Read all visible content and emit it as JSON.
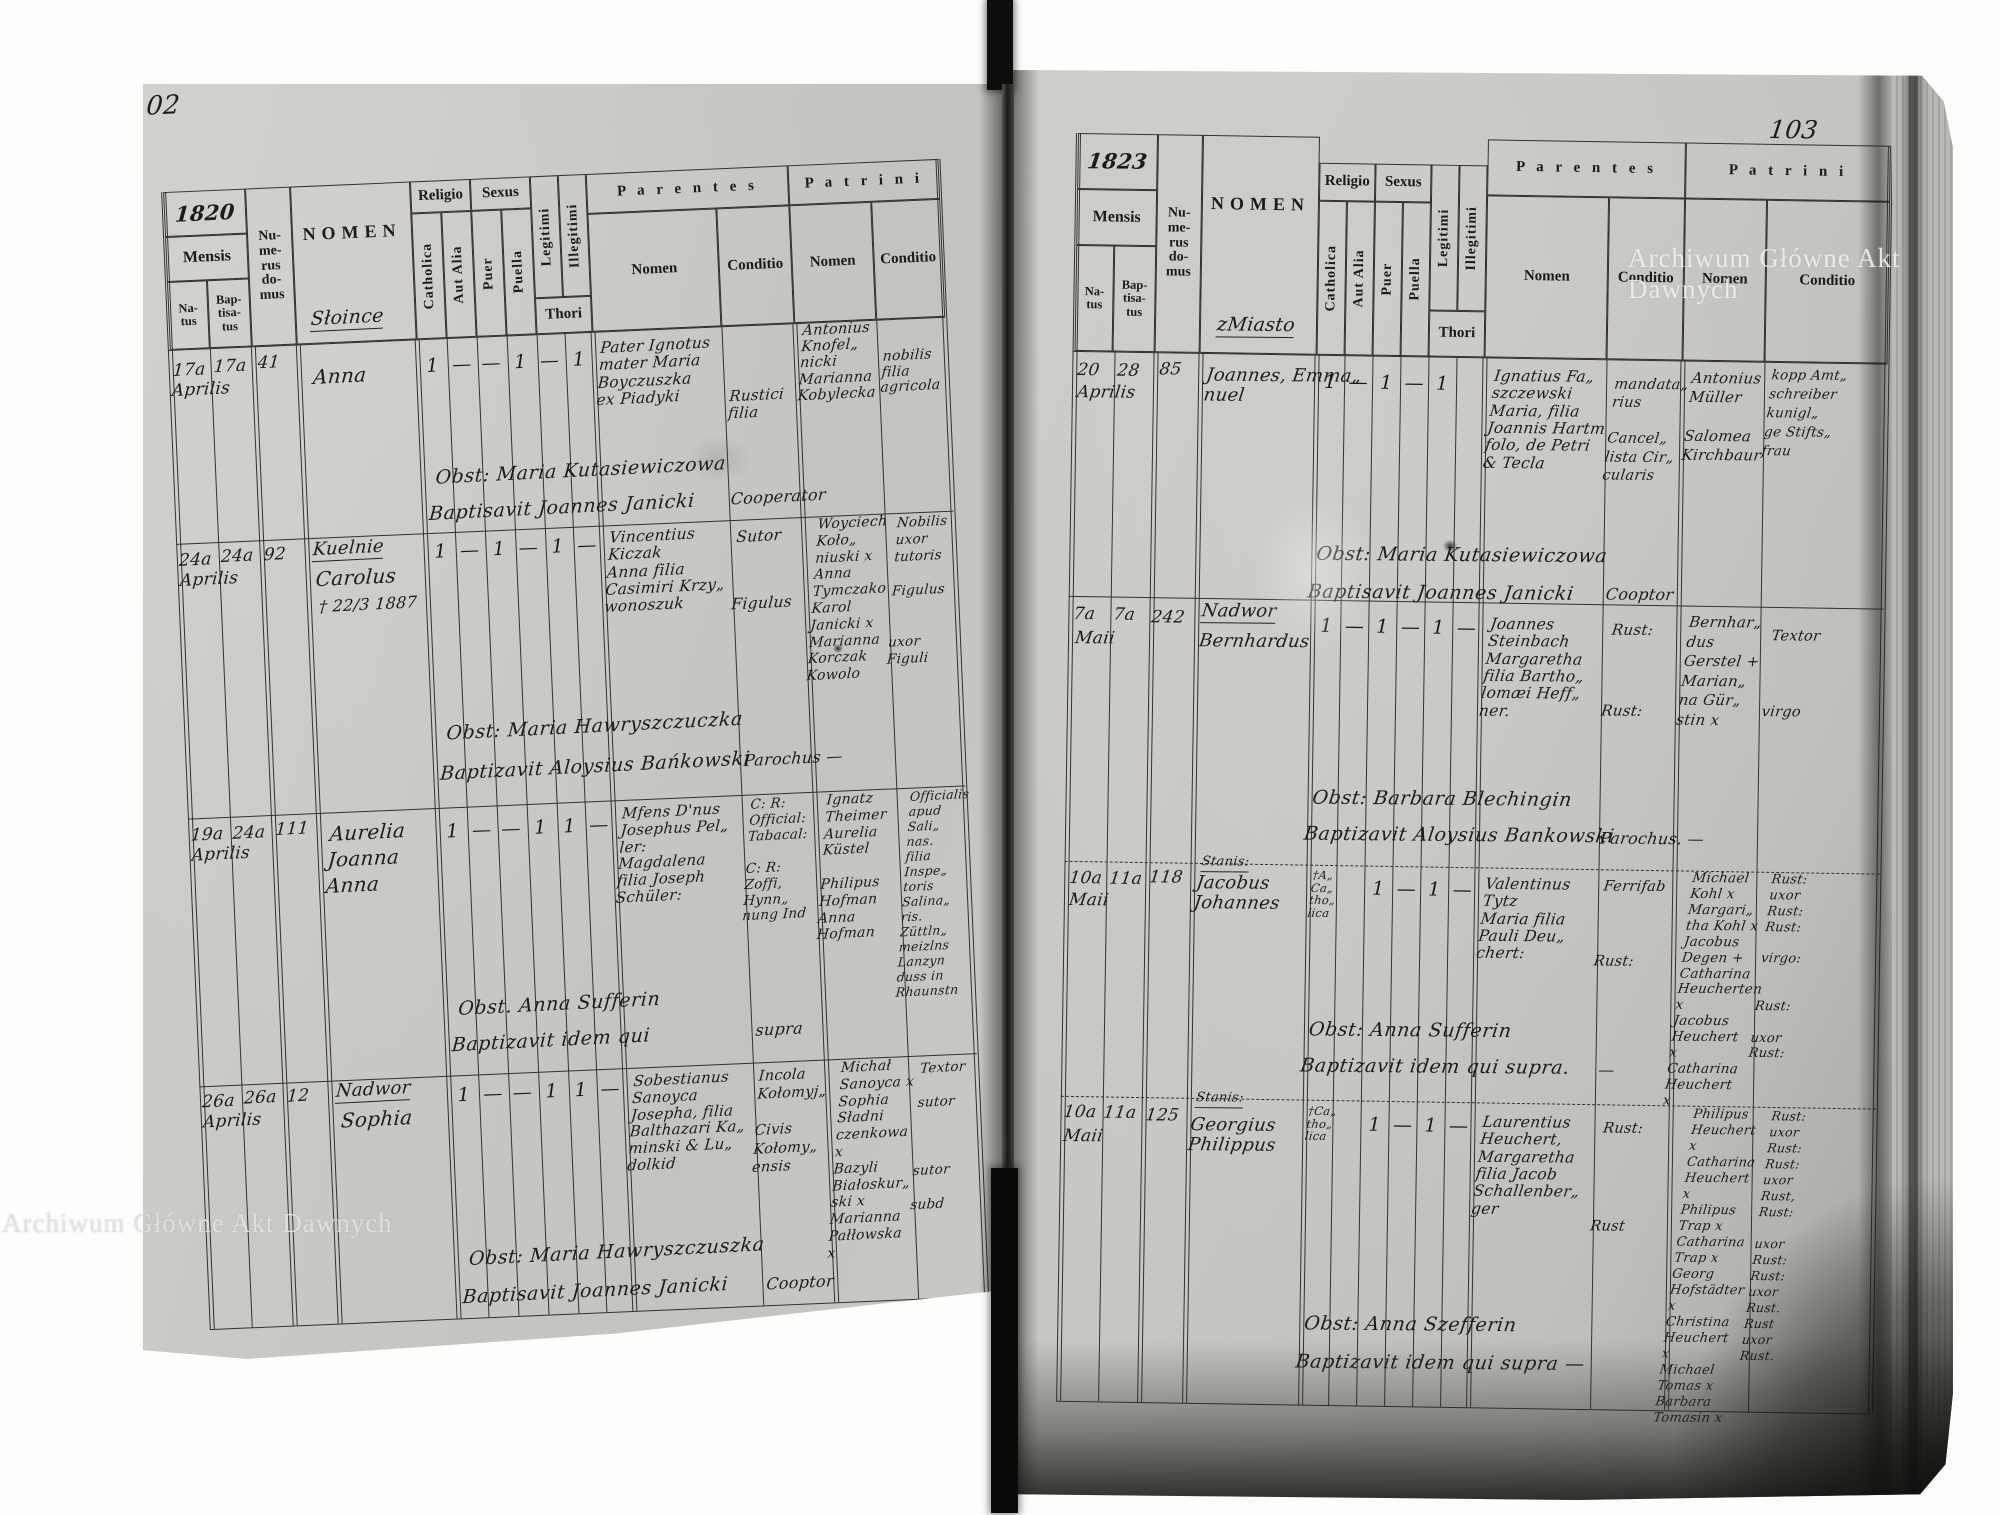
{
  "watermark": {
    "text": "Archiwum Główne Akt Dawnych"
  },
  "headers": {
    "mensis": "Mensis",
    "natus": "Na-\ntus",
    "baptisatus": "Bap-\ntisa-\ntus",
    "numerus_domus": "Nu-\nme-\nrus\ndo-\nmus",
    "nomen": "NOMEN",
    "religio": "Religio",
    "sexus": "Sexus",
    "catholica": "Catholica",
    "aut_alia": "Aut Alia",
    "puer": "Puer",
    "puella": "Puella",
    "legitimi": "Legitimi",
    "illegitimi": "Illegitimi",
    "thori": "Thori",
    "parentes": "P a r e n t e s",
    "patrini": "P a t r i n i",
    "nomen_sub": "Nomen",
    "conditio": "Conditio"
  },
  "left_page": {
    "page_number": "102",
    "year": "1820",
    "place_heading": "Słoince",
    "rows": [
      {
        "natus": "17a",
        "baptisatus": "17a",
        "month": "Aprilis",
        "house": "41",
        "heading": "",
        "name": "Anna",
        "note": "",
        "marks": [
          "1",
          "—",
          "—",
          "1",
          "—",
          "1"
        ],
        "parentes_nomen": "Pater Ignotus\nmater Maria\nBoyczuszka\nex Piadyki",
        "parentes_conditio": "Rustici\nfilia",
        "patrini_nomen": "Antonius\nKnofel„\nnicki\nMarianna\nKobylecka",
        "patrini_conditio": "nobilis\nfilia\nagricola",
        "obstetrix": "Obst: Maria Kutasiewiczowa",
        "baptizavit": "Baptisavit Joannes Janicki",
        "obst_conditio": "Cooperator"
      },
      {
        "natus": "24a",
        "baptisatus": "24a",
        "month": "Aprilis",
        "house": "92",
        "heading": "Kuelnie",
        "name": "Carolus",
        "note": "† 22/3 1887",
        "marks": [
          "1",
          "—",
          "1",
          "—",
          "1",
          "—"
        ],
        "parentes_nomen": "Vincentius\nKiczak\nAnna filia\nCasimiri Krzy„\nwonoszuk",
        "parentes_conditio": "Sutor\n\n\nFigulus",
        "patrini_nomen": "Woyciech\nKoło„\nniuski x\nAnna\nTymczako\nKarol\nJanicki x\nMarianna\nKorczak\nKowolo",
        "patrini_conditio": "Nobilis\nuxor\ntutoris\n\nFigulus\n\n\nuxor\nFiguli",
        "obstetrix": "Obst: Maria Hawryszczuczka",
        "baptizavit": "Baptizavit Aloysius Bańkowski",
        "obst_conditio": "Parochus —"
      },
      {
        "natus": "19a",
        "baptisatus": "24a",
        "month": "Aprilis",
        "house": "111",
        "heading": "",
        "name": "Aurelia\nJoanna\nAnna",
        "note": "",
        "marks": [
          "1",
          "—",
          "—",
          "1",
          "1",
          "—"
        ],
        "parentes_nomen": "Mfens D'nus\nJosephus Pel„\nler:\nMagdalena\nfilia Joseph\nSchüler:",
        "parentes_conditio": "C: R:\nOfficial:\nTabacal:\n\nC: R:\nZoffi,\nHynn„\nnung Ind",
        "patrini_nomen": "Ignatz\nTheimer\nAurelia\nKüstel\n\nPhilipus\nHofman\nAnna\nHofman",
        "patrini_conditio": "Officialis\napud Sali„\nnas.\nfilia Inspe„\ntoris Salina„\nris.\nZüttln„\nmeizlns\nLanzyn\nduss in\nRhaunstn",
        "obstetrix": "Obst. Anna Sufferin",
        "baptizavit": "Baptizavit idem qui",
        "obst_conditio": "supra"
      },
      {
        "natus": "26a",
        "baptisatus": "26a",
        "month": "Aprilis",
        "house": "12",
        "heading": "Nadwor",
        "name": "Sophia",
        "note": "",
        "marks": [
          "1",
          "—",
          "—",
          "1",
          "1",
          "—"
        ],
        "parentes_nomen": "Sobestianus\nSanoyca\nJosepha, filia\nBalthazari Ka„\nminski & Lu„\ndolkid",
        "parentes_conditio": "Incola\nKołomyj„\n\nCivis\nKołomy„\nensis",
        "patrini_nomen": "Michał\nSanoyca x\nSophia\nSładni\nczenkowa x\nBazyli\nBiałoskur„\nski x\nMarianna\nPałłowska x",
        "patrini_conditio": "Textor\n\nsutor\n\n\n\nsutor\n\nsubd",
        "obstetrix": "Obst: Maria Hawryszczuszka",
        "baptizavit": "Baptisavit Joannes Janicki",
        "obst_conditio": "Cooptor"
      }
    ]
  },
  "right_page": {
    "page_number": "103",
    "year": "1823",
    "place_heading": "zMiasto",
    "rows": [
      {
        "natus": "20",
        "baptisatus": "28",
        "month": "Aprilis",
        "house": "85",
        "heading": "",
        "name": "Joannes, Emma„\nnuel",
        "religio_note": "",
        "marks": [
          "1",
          "—",
          "1",
          "—",
          "1",
          ""
        ],
        "parentes_nomen": "Ignatius Fa„\nszczewski\nMaria, filia\nJoannis Hartm\nfolo, de Petri\n& Tecla",
        "parentes_conditio": "mandata„\nrius\n\nCancel„\nlista Cir„\ncularis",
        "patrini_nomen": "Antonius\nMüller\n\nSalomea\nKirchbaur",
        "patrini_conditio": "kopp Amt„\nschreiber\nkunigl„\nge Stifts„\nfrau",
        "obstetrix": "Obst: Maria Kutasiewiczowa",
        "baptizavit": "Baptisavit Joannes Janicki",
        "obst_conditio": "Cooptor"
      },
      {
        "natus": "7a",
        "baptisatus": "7a",
        "month": "Maii",
        "house": "242",
        "heading": "Nadwor",
        "name": "Bernhardus",
        "religio_note": "",
        "marks": [
          "1",
          "—",
          "1",
          "—",
          "1",
          "—"
        ],
        "parentes_nomen": "Joannes\nSteinbach\nMargaretha\nfilia Bartho„\nlomæi Heff„\nner.",
        "parentes_conditio": "Rust:\n\n\n\nRust:",
        "patrini_nomen": "Bernhar„\ndus\nGerstel +\nMarian„\nna Gür„\nstin x",
        "patrini_conditio": "Textor\n\n\nvirgo",
        "obstetrix": "Obst: Barbara Blechingin",
        "baptizavit": "Baptizavit Aloysius Bankowski",
        "obst_conditio": "Parochus. —"
      },
      {
        "natus": "10a",
        "baptisatus": "11a",
        "month": "Maii",
        "house": "118",
        "heading": "Stanis:",
        "name": "Jacobus\nJohannes",
        "religio_note": "†A„\nCa„\ntho„\nlica",
        "marks": [
          "",
          "",
          "1",
          "—",
          "1",
          "—"
        ],
        "parentes_nomen": "Valentinus\nTytz\nMaria filia\nPauli Deu„\nchert:",
        "parentes_conditio": "Ferrifab\n\n\n\nRust:",
        "patrini_nomen": "Michael\nKohl x\nMargari„\ntha Kohl x\nJacobus\nDegen +\nCatharina\nHeucherten x\nJacobus\nHeuchert x\nCatharina\nHeuchert x",
        "patrini_conditio": "Rust:\nuxor\nRust:\nRust:\n\nvirgo:\n\n\nRust:\n\nuxor\nRust:",
        "obstetrix": "Obst: Anna Sufferin",
        "baptizavit": "Baptizavit idem qui supra.",
        "obst_conditio": "—"
      },
      {
        "natus": "10a",
        "baptisatus": "11a",
        "month": "Maii",
        "house": "125",
        "heading": "Stanis:",
        "name": "Georgius\nPhilippus",
        "religio_note": "†Ca„\ntho„\nlica",
        "marks": [
          "",
          "",
          "1",
          "—",
          "1",
          "—"
        ],
        "parentes_nomen": "Laurentius\nHeuchert,\nMargaretha\nfilia Jacob\nSchallenber„\nger",
        "parentes_conditio": "Rust:\n\n\n\n\nRust",
        "patrini_nomen": "Philipus\nHeuchert x\nCatharina\nHeuchert x\nPhilipus\nTrap x\nCatharina\nTrap x\nGeorg\nHofstädter x\nChristina\nHeuchert x\nMichael\nTomas x\nBarbara\nTomasin x",
        "patrini_conditio": "Rust:\nuxor\nRust:\nRust:\nuxor\nRust,\nRust:\n\nuxor\nRust:\nRust:\nuxor\nRust.\nRust\nuxor\nRust.",
        "obstetrix": "Obst: Anna Szefferin",
        "baptizavit": "Baptizavit idem qui supra —",
        "obst_conditio": ""
      }
    ]
  }
}
